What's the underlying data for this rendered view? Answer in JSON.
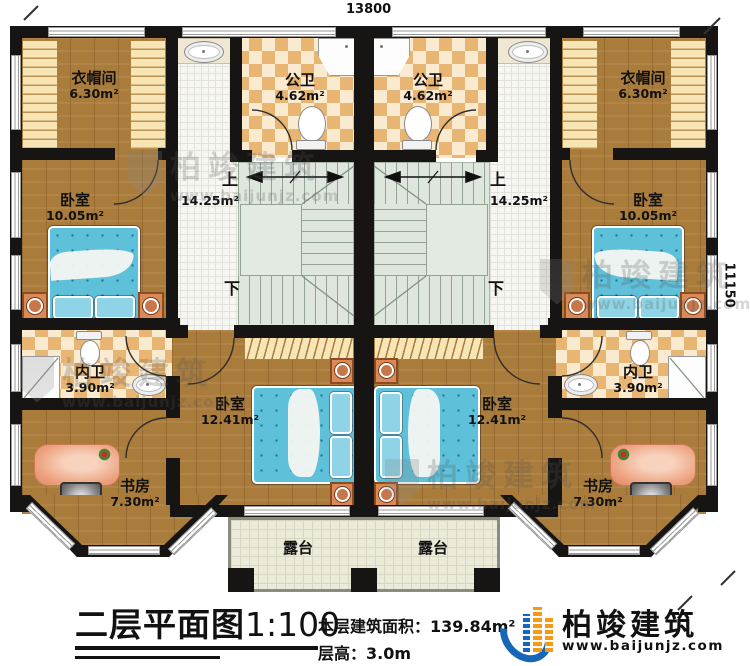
{
  "dimensions": {
    "top": "13800",
    "right": "11150"
  },
  "rooms": {
    "cloak_left": {
      "name": "衣帽间",
      "area": "6.30m²"
    },
    "cloak_right": {
      "name": "衣帽间",
      "area": "6.30m²"
    },
    "pubbath_left": {
      "name": "公卫",
      "area": "4.62m²"
    },
    "pubbath_right": {
      "name": "公卫",
      "area": "4.62m²"
    },
    "bedroom_left": {
      "name": "卧室",
      "area": "10.05m²"
    },
    "bedroom_right": {
      "name": "卧室",
      "area": "10.05m²"
    },
    "stairs_left": {
      "up": "上",
      "down": "下",
      "area": "14.25m²"
    },
    "stairs_right": {
      "up": "上",
      "down": "下",
      "area": "14.25m²"
    },
    "ensuite_left": {
      "name": "内卫",
      "area": "3.90m²"
    },
    "ensuite_right": {
      "name": "内卫",
      "area": "3.90m²"
    },
    "bedroom2_left": {
      "name": "卧室",
      "area": "12.41m²"
    },
    "bedroom2_right": {
      "name": "卧室",
      "area": "12.41m²"
    },
    "study_left": {
      "name": "书房",
      "area": "7.30m²"
    },
    "study_right": {
      "name": "书房",
      "area": "7.30m²"
    },
    "terrace_left": {
      "name": "露台"
    },
    "terrace_right": {
      "name": "露台"
    }
  },
  "footer": {
    "title": "二层平面图",
    "scale": "1:100",
    "area_label": "本层建筑面积：",
    "area_value": "139.84m²",
    "floor_height_label": "层高：",
    "floor_height_value": "3.0m"
  },
  "brand": {
    "name": "柏竣建筑",
    "website": "www.baijunjz.com"
  },
  "watermark": {
    "name": "柏竣建筑",
    "website": "www.baijunjz.com"
  },
  "colors": {
    "wall": "#171513",
    "wood": "#aa7c3c",
    "bath_tile": "#e9b572",
    "stair": "#dee6de",
    "terrace": "#ecead8",
    "bed": "#5fc0da",
    "brand_blue": "#1766b8",
    "brand_orange": "#f49a16"
  }
}
